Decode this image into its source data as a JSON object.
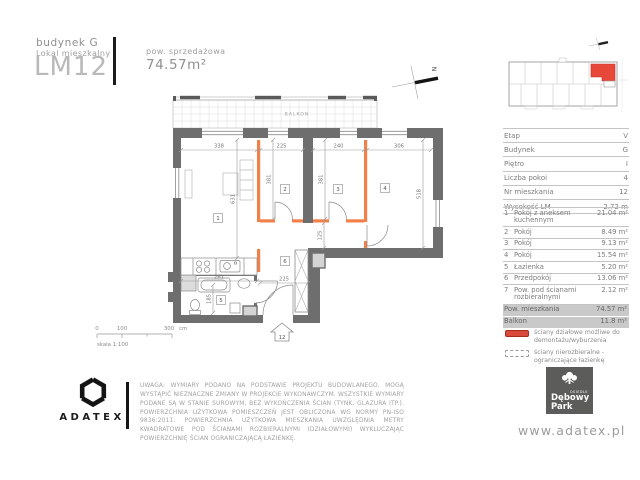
{
  "header": {
    "building": "budynek G",
    "unit_type": "Lokal mieszkalny",
    "unit_code": "LM12",
    "area_label": "pow. sprzedażowa",
    "area_value": "74.57m²"
  },
  "info_table": {
    "rows": [
      {
        "label": "Etap",
        "value": "V"
      },
      {
        "label": "Budynek",
        "value": "G"
      },
      {
        "label": "Piętro",
        "value": "I"
      },
      {
        "label": "Liczba pokoi",
        "value": "4"
      },
      {
        "label": "Nr mieszkania",
        "value": "12"
      },
      {
        "label": "Wysokość LM",
        "value": "2.72 m"
      }
    ]
  },
  "rooms_table": {
    "rows": [
      {
        "no": "1",
        "name": "Pokój z aneksem kuchennym",
        "area": "21.04 m²"
      },
      {
        "no": "2",
        "name": "Pokój",
        "area": "8.49 m²"
      },
      {
        "no": "3",
        "name": "Pokój",
        "area": "9.13 m²"
      },
      {
        "no": "4",
        "name": "Pokój",
        "area": "15.54 m²"
      },
      {
        "no": "5",
        "name": "Łazienka",
        "area": "5.20 m²"
      },
      {
        "no": "6",
        "name": "Przedpokój",
        "area": "13.06 m²"
      },
      {
        "no": "7",
        "name": "Pow. pod ścianami rozbieralnymi",
        "area": "2.12 m²"
      }
    ],
    "totals": [
      {
        "name": "Pow. mieszkania",
        "area": "74.57 m²"
      },
      {
        "name": "Balkon",
        "area": "11.8 m²"
      }
    ]
  },
  "legend": {
    "items": [
      {
        "label": "ściany działowe możliwe do demontażu/wyburzenia",
        "swatch": "red-solid"
      },
      {
        "label": "ściany nierozbieralne - ograniczające łazienkę",
        "swatch": "dashed-outline"
      }
    ]
  },
  "plan": {
    "balcony_label": "BALKON",
    "north_label": "N",
    "entrance_number": "12",
    "room_numbers": {
      "r1": "1",
      "r2": "2",
      "r3": "3",
      "r4": "4",
      "r5": "5",
      "r6": "6"
    },
    "dims": {
      "top1": "338",
      "top2": "225",
      "top3": "240",
      "top4": "306",
      "v_room1": "631",
      "v_room2": "381",
      "v_room3": "381",
      "v_room4": "518",
      "v_hall": "125",
      "v_bath": "185",
      "h_kitchen": "261",
      "h_hall": "225"
    },
    "scale": {
      "t0": "0",
      "t100": "100",
      "t300": "300",
      "unit": "cm",
      "label": "skala 1:100"
    }
  },
  "colors": {
    "wall": "#6e6e6e",
    "demolishable_wall": "#f28048",
    "legend_red": "#d84a3c",
    "highlight_unit": "#e8483a",
    "table_total_bg": "#c9c9c9"
  },
  "footer": {
    "brand": "ADATEX",
    "disclaimer": "UWAGA: WYMIARY PODANO NA PODSTAWIE PROJEKTU BUDOWLANEGO. MOGĄ WYSTĄPIĆ NIEZNACZNE ZMIANY W PROJEKCIE WYKONAWCZYM. WSZYSTKIE WYMIARY PODANE SĄ W STANIE SUROWYM, BEZ WYKOŃCZENIA ŚCIAN (TYNK, GLAZURA ITP.). POWIERZCHNIA UŻYTKOWA POMIESZCZEŃ JEST OBLICZONA WG NORMY PN-ISO 9836:2011. POWIERZCHNIA UŻYTKOWA MIESZKANIA UWZGLĘDNIA METRY KWADRATOWE POD ŚCIANAMI ROZBIERALNYMI (DZIAŁOWYMI) WYKLUCZAJĄC POWIERZCHNIĘ ŚCIAN OGRANICZAJĄCĄ ŁAZIENKĘ.",
    "estate_label": "OSIEDLE",
    "estate_name_line1": "Dębowy",
    "estate_name_line2": "Park",
    "website": "www.adatex.pl"
  }
}
